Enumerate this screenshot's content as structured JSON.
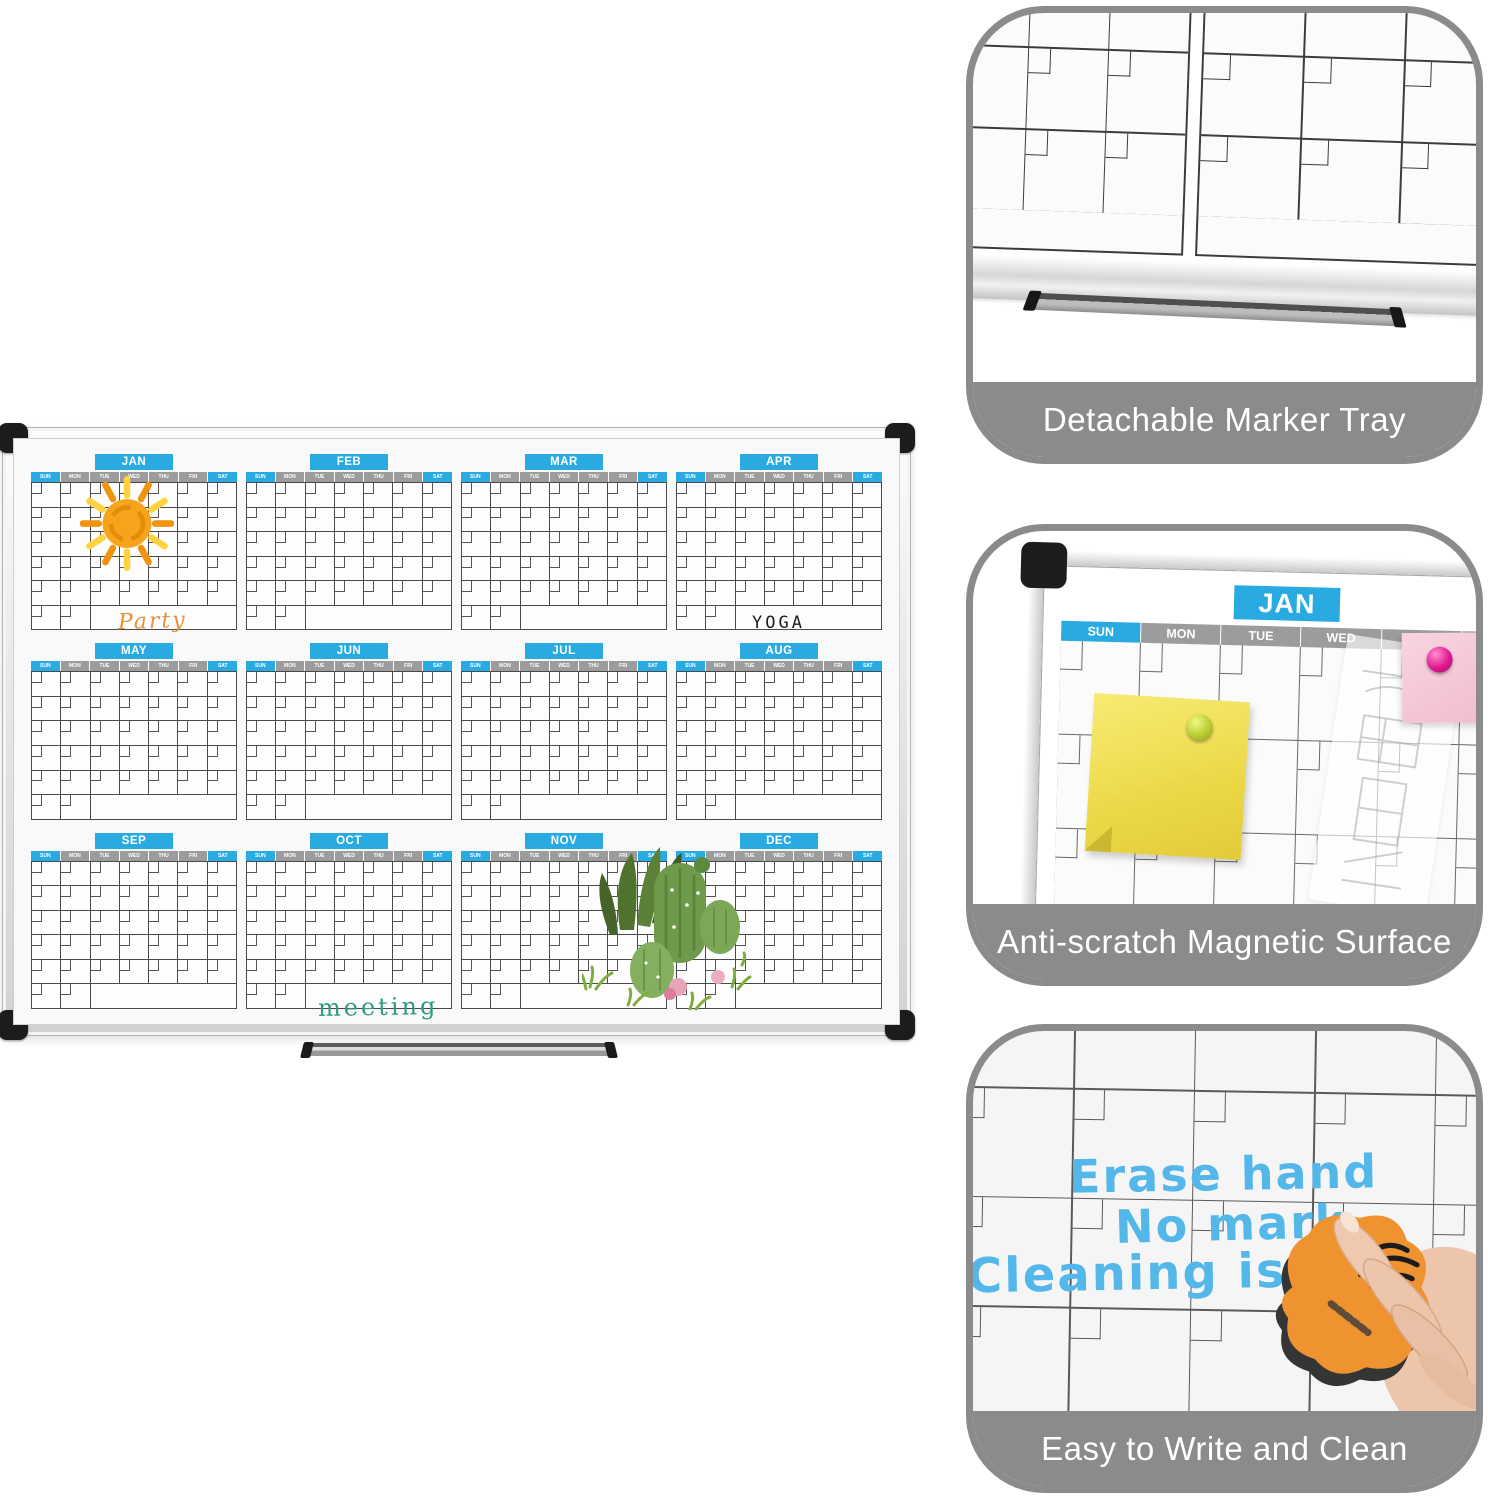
{
  "board": {
    "months": [
      "JAN",
      "FEB",
      "MAR",
      "APR",
      "MAY",
      "JUN",
      "JUL",
      "AUG",
      "SEP",
      "OCT",
      "NOV",
      "DEC"
    ],
    "days": [
      "SUN",
      "MON",
      "TUE",
      "WED",
      "THU",
      "FRI",
      "SAT"
    ],
    "annotations": {
      "jan": "Party",
      "apr": "YOGA",
      "oct": "meeting"
    },
    "decorations": [
      "sun-drawing",
      "cactus-drawing",
      "marker-tray"
    ]
  },
  "panels": [
    {
      "caption": "Detachable Marker Tray",
      "decorations": [
        "whiteboard-grid-closeup",
        "bottom-frame-rail",
        "detached-marker-tray"
      ]
    },
    {
      "caption": "Anti-scratch Magnetic Surface",
      "month_label": "JAN",
      "decorations": [
        "corner-cap",
        "frame-rails",
        "sticky-note-yellow",
        "sticky-note-pink",
        "pin-green",
        "pin-magenta",
        "sketch-paper"
      ]
    },
    {
      "caption": "Easy to Write and Clean",
      "handwriting": [
        "Erase hand",
        "No mark",
        "Cleaning is m"
      ],
      "decorations": [
        "eraser",
        "hand"
      ]
    }
  ],
  "colors": {
    "accent_blue": "#29ABE2",
    "day_strip_gray": "#9C9C9C",
    "panel_gray": "#8B8B8B",
    "marker_blue": "#54B7E9",
    "note_yellow": "#F2E25A",
    "note_pink": "#F5C6D5",
    "annotation_orange": "#E8913C",
    "annotation_green": "#2F9B82"
  }
}
